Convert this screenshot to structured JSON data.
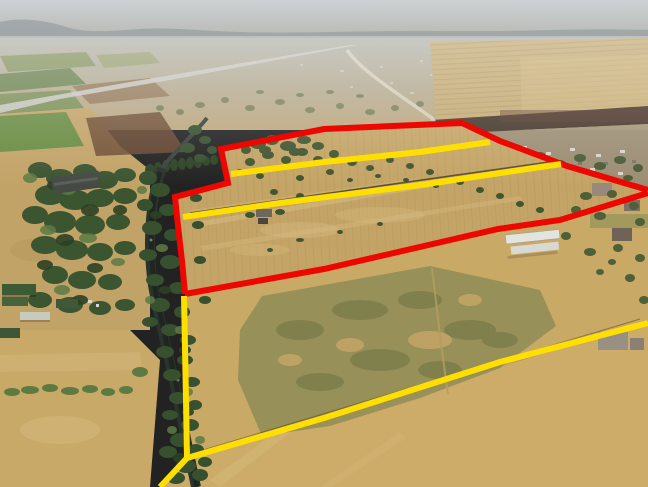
{
  "image": {
    "kind": "aerial-drone-photograph",
    "subject": "farmland with surveyed property boundaries highlighted",
    "width": 648,
    "height": 487
  },
  "overlay": {
    "colors": {
      "red": "#ec0700",
      "yellow": "#ffdf00"
    },
    "stroke_width": 6,
    "polylines": [
      {
        "name": "red-parcel-top-and-left-boundary",
        "color": "red",
        "points": [
          [
            648,
            190
          ],
          [
            567,
            166
          ],
          [
            500,
            141
          ],
          [
            462,
            123
          ],
          [
            324,
            129
          ],
          [
            221,
            149
          ],
          [
            228,
            183
          ],
          [
            175,
            197
          ],
          [
            178,
            226
          ],
          [
            182,
            261
          ],
          [
            185,
            294
          ]
        ]
      },
      {
        "name": "red-parcel-lower-diagonal-boundary",
        "color": "red",
        "points": [
          [
            185,
            294
          ],
          [
            324,
            269
          ],
          [
            498,
            229
          ],
          [
            560,
            220
          ],
          [
            648,
            193
          ]
        ]
      },
      {
        "name": "yellow-divider-upper",
        "color": "yellow",
        "points": [
          [
            231,
            174
          ],
          [
            324,
            162
          ],
          [
            420,
            152
          ],
          [
            490,
            142
          ]
        ]
      },
      {
        "name": "yellow-divider-middle",
        "color": "yellow",
        "points": [
          [
            183,
            217
          ],
          [
            280,
            203
          ],
          [
            420,
            185
          ],
          [
            561,
            164
          ]
        ]
      },
      {
        "name": "yellow-river-edge-boundary",
        "color": "yellow",
        "points": [
          [
            184,
            296
          ],
          [
            186,
            400
          ],
          [
            187,
            458
          ]
        ]
      },
      {
        "name": "yellow-bottom-left-boundary",
        "color": "yellow",
        "points": [
          [
            187,
            458
          ],
          [
            160,
            487
          ]
        ]
      },
      {
        "name": "yellow-long-diagonal-boundary",
        "color": "yellow",
        "points": [
          [
            187,
            458
          ],
          [
            324,
            418
          ],
          [
            500,
            362
          ],
          [
            648,
            323
          ]
        ]
      }
    ]
  }
}
